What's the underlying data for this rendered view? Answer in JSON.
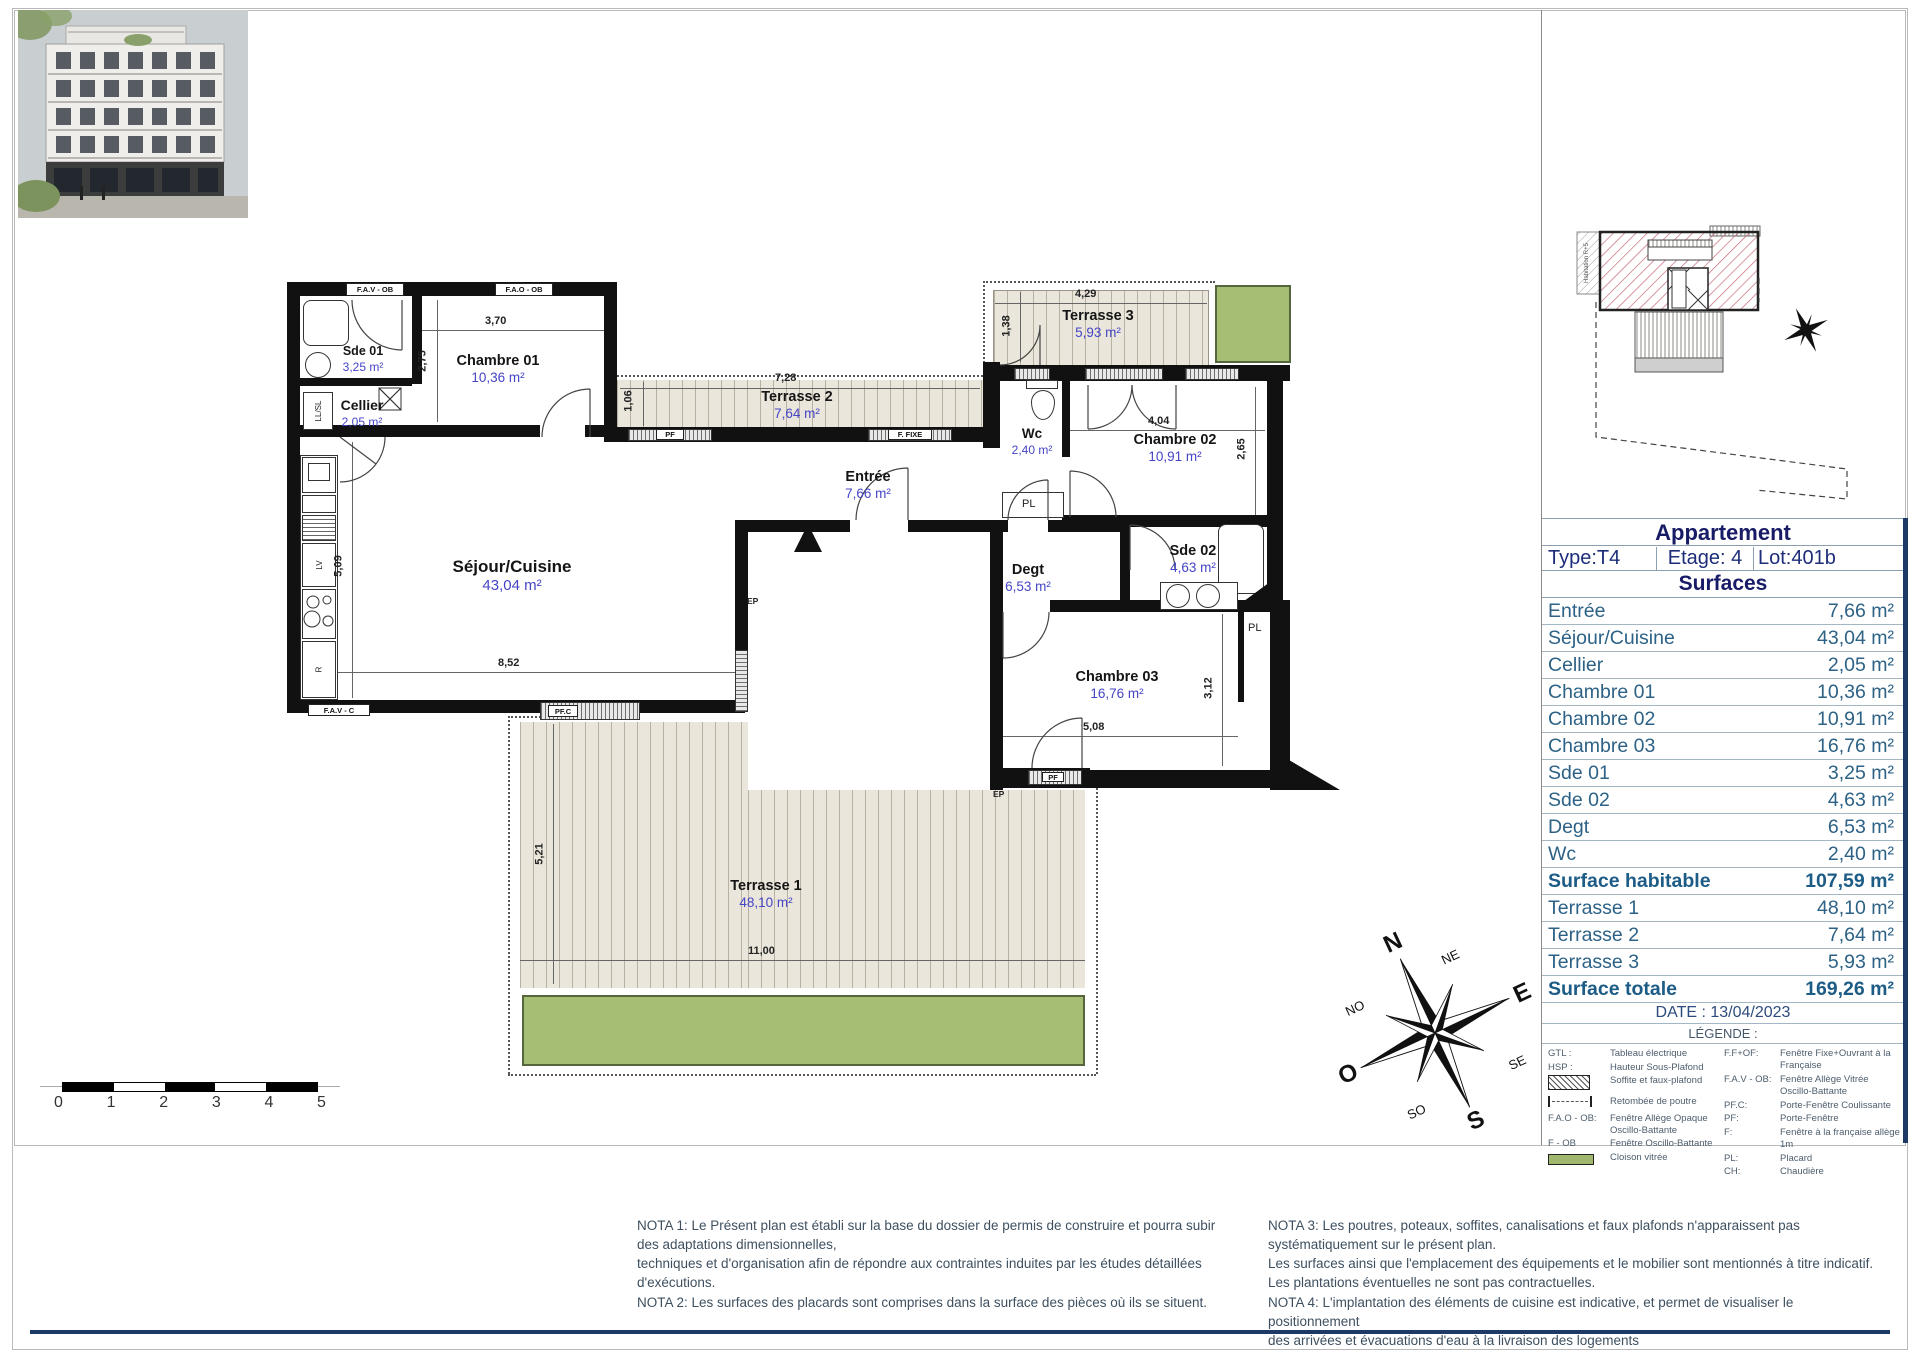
{
  "panel": {
    "title": "Appartement",
    "type": "Type:T4",
    "etage": "Etage: 4",
    "lot": "Lot:401b",
    "surfaces_title": "Surfaces",
    "rows": [
      {
        "label": "Entrée",
        "value": "7,66 m²"
      },
      {
        "label": "Séjour/Cuisine",
        "value": "43,04 m²"
      },
      {
        "label": "Cellier",
        "value": "2,05 m²"
      },
      {
        "label": "Chambre 01",
        "value": "10,36 m²"
      },
      {
        "label": "Chambre 02",
        "value": "10,91 m²"
      },
      {
        "label": "Chambre 03",
        "value": "16,76 m²"
      },
      {
        "label": "Sde 01",
        "value": "3,25 m²"
      },
      {
        "label": "Sde 02",
        "value": "4,63 m²"
      },
      {
        "label": "Degt",
        "value": "6,53 m²"
      },
      {
        "label": "Wc",
        "value": "2,40 m²"
      },
      {
        "label": "Surface habitable",
        "value": "107,59 m²"
      },
      {
        "label": "Terrasse 1",
        "value": "48,10 m²"
      },
      {
        "label": "Terrasse 2",
        "value": "7,64 m²"
      },
      {
        "label": "Terrasse 3",
        "value": "5,93 m²"
      },
      {
        "label": "Surface totale",
        "value": "169,26 m²"
      }
    ],
    "date": "DATE : 13/04/2023",
    "legend_title": "LÉGENDE :",
    "legend_left": [
      {
        "term": "GTL :",
        "desc": "Tableau électrique"
      },
      {
        "term": "HSP :",
        "desc": "Hauteur Sous-Plafond"
      },
      {
        "term": "",
        "desc": "Soffite et faux-plafond"
      },
      {
        "term": "",
        "desc": "Retombée de poutre"
      },
      {
        "term": "F.A.O - OB:",
        "desc": "Fenêtre Allège Opaque Oscillo-Battante"
      },
      {
        "term": "F - OB",
        "desc": "Fenêtre Oscillo-Battante"
      },
      {
        "term": "",
        "desc": "Cloison vitrée"
      }
    ],
    "legend_right": [
      {
        "term": "F.F+OF:",
        "desc": "Fenêtre Fixe+Ouvrant à la Française"
      },
      {
        "term": "F.A.V - OB:",
        "desc": "Fenêtre Allège Vitrée Oscillo-Battante"
      },
      {
        "term": "PF.C:",
        "desc": "Porte-Fenêtre Coulissante"
      },
      {
        "term": "PF:",
        "desc": "Porte-Fenêtre"
      },
      {
        "term": "F:",
        "desc": "Fenêtre à la française allège 1m"
      },
      {
        "term": "PL:",
        "desc": "Placard"
      },
      {
        "term": "CH:",
        "desc": "Chaudière"
      }
    ]
  },
  "plan": {
    "rooms": [
      {
        "name": "Sde 01",
        "area": "3,25 m²"
      },
      {
        "name": "Chambre 01",
        "area": "10,36 m²"
      },
      {
        "name": "Cellier",
        "area": "2,05 m²"
      },
      {
        "name": "Séjour/Cuisine",
        "area": "43,04 m²"
      },
      {
        "name": "Entrée",
        "area": "7,66 m²"
      },
      {
        "name": "Terrasse 2",
        "area": "7,64 m²"
      },
      {
        "name": "Terrasse 3",
        "area": "5,93 m²"
      },
      {
        "name": "Wc",
        "area": "2,40 m²"
      },
      {
        "name": "Chambre 02",
        "area": "10,91 m²"
      },
      {
        "name": "Sde 02",
        "area": "4,63 m²"
      },
      {
        "name": "Degt",
        "area": "6,53 m²"
      },
      {
        "name": "Chambre 03",
        "area": "16,76 m²"
      },
      {
        "name": "Terrasse 1",
        "area": "48,10 m²"
      }
    ],
    "dims": {
      "ch01_w": "3,70",
      "ch01_h": "2,75",
      "t2_w": "7,28",
      "t2_h": "1,06",
      "t3_w": "4,29",
      "t3_h": "1,38",
      "ch02_w": "4,04",
      "ch02_h": "2,65",
      "sej_h": "5,09",
      "sej_w": "8,52",
      "ch03_w": "5,08",
      "ch03_h": "3,12",
      "t1_h": "5,21",
      "t1_w": "11,00"
    },
    "wall_labels": {
      "w1": "F.A.V - OB",
      "w2": "F.A.O - OB",
      "w3": "PF",
      "w4": "F. FIXE",
      "w5": "F.A.V - C",
      "w6": "PF.C",
      "w7": "PF"
    },
    "fixtures": {
      "llsl": "LL/SL",
      "lv": "LV",
      "r": "R",
      "pl1": "PL",
      "pl2": "PL",
      "ep1": "EP",
      "ep2": "EP"
    }
  },
  "compass": {
    "n": "N",
    "ne": "NE",
    "e": "E",
    "se": "SE",
    "s": "S",
    "so": "SO",
    "o": "O",
    "no": "NO"
  },
  "scale": {
    "ticks": [
      "0",
      "1",
      "2",
      "3",
      "4",
      "5"
    ]
  },
  "site_plan": {
    "label": "Habitation  R+5"
  },
  "notes": {
    "left": "NOTA 1: Le Présent plan est établi sur la base du dossier de permis de construire et pourra subir\ndes adaptations dimensionnelles,\ntechniques et d'organisation afin de répondre aux contraintes induites par les études détaillées\nd'exécutions.\nNOTA 2: Les surfaces des placards sont comprises dans la surface des pièces où ils se situent.",
    "right": "NOTA 3: Les poutres, poteaux, soffites, canalisations et faux plafonds n'apparaissent pas\nsystématiquement sur le présent plan.\nLes surfaces ainsi que l'emplacement des équipements et le mobilier sont mentionnés à titre indicatif.\nLes plantations éventuelles ne sont pas contractuelles.\nNOTA 4: L'implantation des éléments de cuisine est indicative, et permet de visualiser le positionnement\ndes arrivées et évacuations d'eau à la livraison des logements"
  }
}
